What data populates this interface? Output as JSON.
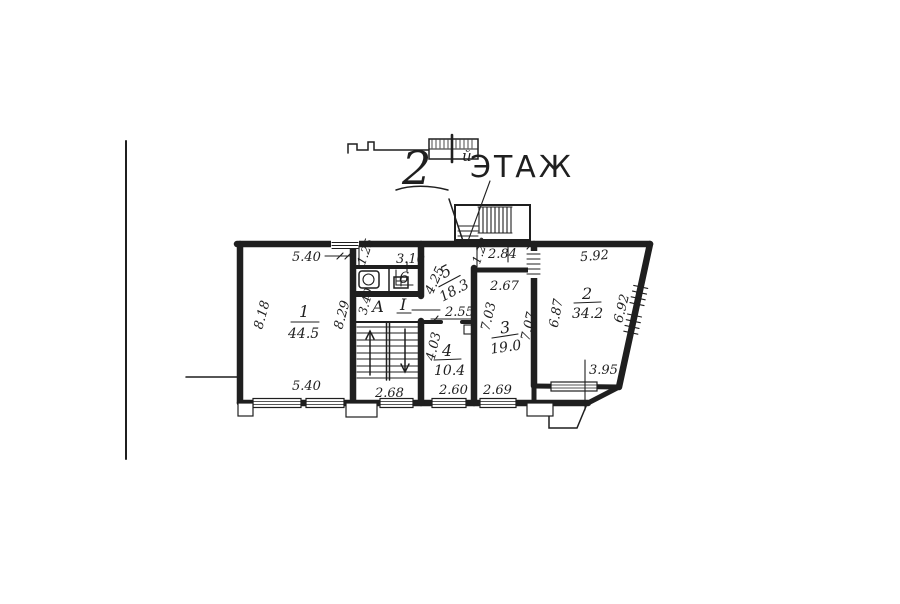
{
  "colors": {
    "ink": "#1f1f1f",
    "paper": "#ffffff"
  },
  "title": {
    "number": "2",
    "suffix": "й",
    "word": "ЭТАЖ"
  },
  "rooms": {
    "r1": {
      "number": "1",
      "area": "44.5"
    },
    "r2": {
      "number": "2",
      "area": "34.2"
    },
    "r3": {
      "number": "3",
      "area": "19.0"
    },
    "r4": {
      "number": "4",
      "area": "10.4"
    },
    "r5": {
      "number": "5",
      "area": "18.3"
    },
    "wc": {
      "number": "6"
    },
    "stairwell": {
      "letter": "А",
      "number": "I"
    }
  },
  "dimensions": {
    "r1_top": "5.40",
    "r1_left": "8.18",
    "r1_right": "8.29",
    "r1_bottom": "5.40",
    "wc_step": "1.25",
    "wc_width": "3.10",
    "stair_hall": "3.40",
    "stair_width": "2.68",
    "r5_height": "4.25",
    "r5_opening": "2.55",
    "r4_height": "4.03",
    "r4_width": "2.60",
    "r3_niche": "1.28",
    "r3_top": "2.84",
    "r3_width": "2.67",
    "r3_left": "7.03",
    "r3_right": "7.07",
    "r3_bottom": "2.69",
    "r2_top": "5.92",
    "r2_left": "6.87",
    "r2_right": "6.92",
    "r2_bottom": "3.95"
  }
}
